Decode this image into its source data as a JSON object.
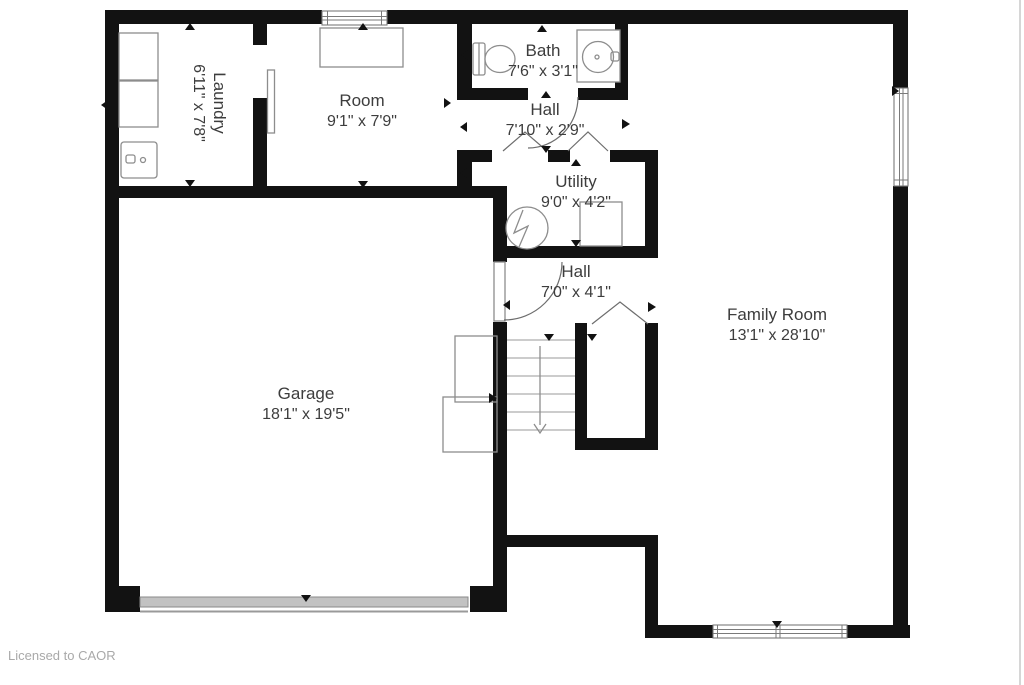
{
  "plan": {
    "watermark": "Licensed to CAOR",
    "rooms": [
      {
        "id": "laundry",
        "name": "Laundry",
        "dims": "6'11\" x 7'8\""
      },
      {
        "id": "room",
        "name": "Room",
        "dims": "9'1\" x 7'9\""
      },
      {
        "id": "bath",
        "name": "Bath",
        "dims": "7'6\" x 3'1\""
      },
      {
        "id": "hall-upper",
        "name": "Hall",
        "dims": "7'10\" x 2'9\""
      },
      {
        "id": "utility",
        "name": "Utility",
        "dims": "9'0\" x 4'2\""
      },
      {
        "id": "hall-lower",
        "name": "Hall",
        "dims": "7'0\" x 4'1\""
      },
      {
        "id": "garage",
        "name": "Garage",
        "dims": "18'1\" x 19'5\""
      },
      {
        "id": "family-room",
        "name": "Family Room",
        "dims": "13'1\" x 28'10\""
      }
    ],
    "colors": {
      "wall": "#121212",
      "fixture": "#8d8d8d",
      "text": "#3d3d3d",
      "watermark": "#a9a9a9",
      "garage_door": "#c2c2c2"
    }
  }
}
